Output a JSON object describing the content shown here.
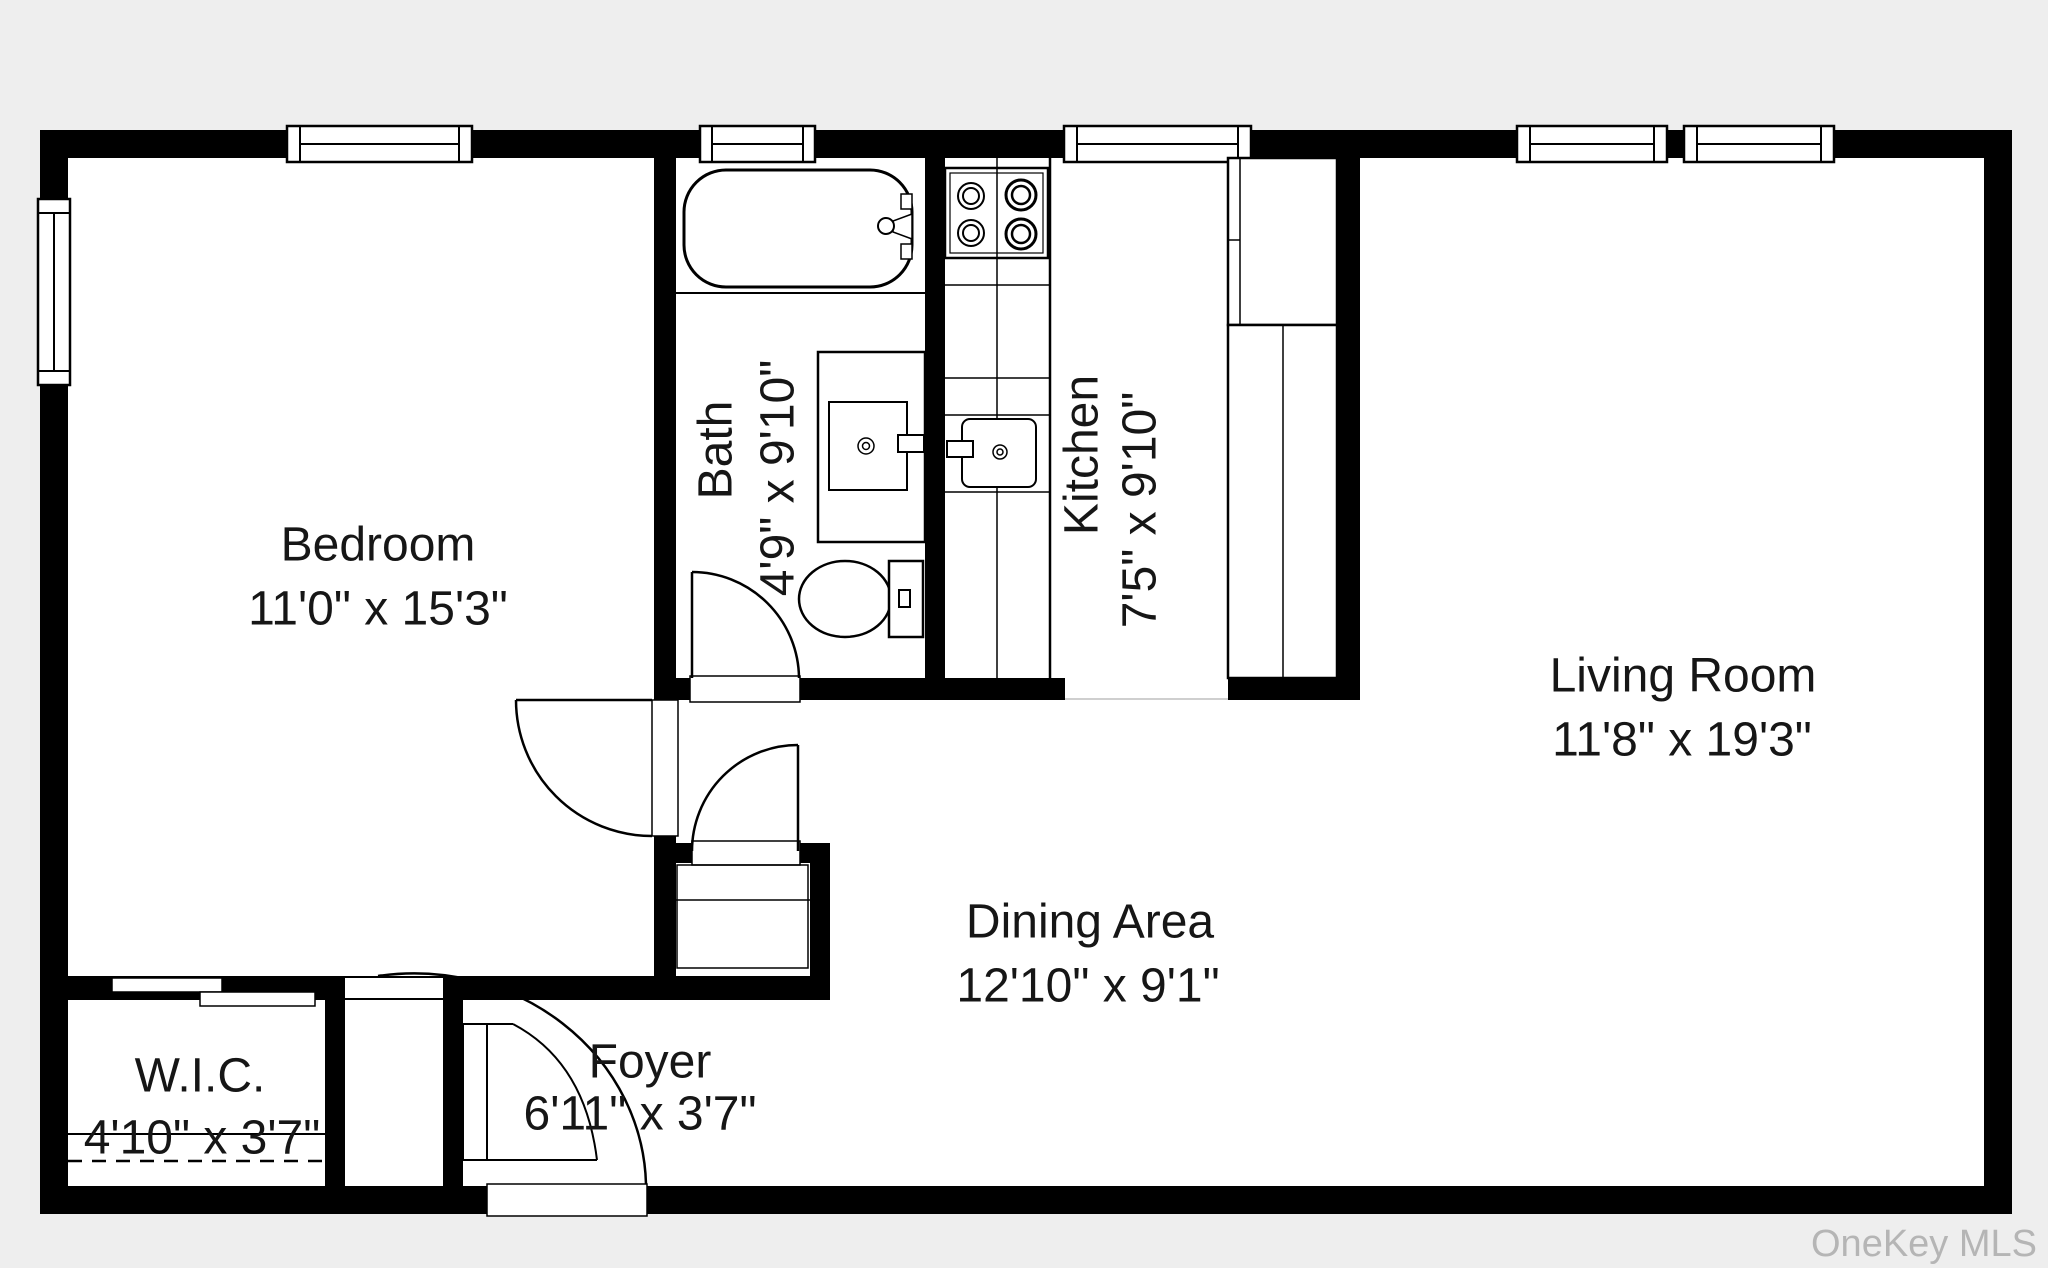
{
  "plan_title": "apartment-floor-plan",
  "rooms": {
    "bedroom": {
      "name": "Bedroom",
      "dims": "11'0\" x 15'3\""
    },
    "bath": {
      "name": "Bath",
      "dims": "4'9\" x 9'10\""
    },
    "kitchen": {
      "name": "Kitchen",
      "dims": "7'5\" x 9'10\""
    },
    "living_room": {
      "name": "Living Room",
      "dims": "11'8\" x 19'3\""
    },
    "dining_area": {
      "name": "Dining Area",
      "dims": "12'10\" x 9'1\""
    },
    "wic": {
      "name": "W.I.C.",
      "dims": "4'10\" x 3'7\""
    },
    "foyer": {
      "name": "Foyer",
      "dims": "6'11\" x 3'7\""
    }
  },
  "watermark": "OneKey MLS",
  "icons": [
    "bathtub-icon",
    "vanity-sink-icon",
    "toilet-icon",
    "stove-icon",
    "kitchen-sink-icon",
    "refrigerator-icon",
    "cabinet-icon",
    "window-icon",
    "door-swing-icon",
    "sliding-door-icon"
  ],
  "colors": {
    "wall": "#000000",
    "room_fill": "#ffffff",
    "background": "#eeeeee",
    "label": "#161616",
    "burner_accent": "#8a8a8a",
    "watermark": "#b5b5b5",
    "threshold": "#cfcfcf"
  }
}
